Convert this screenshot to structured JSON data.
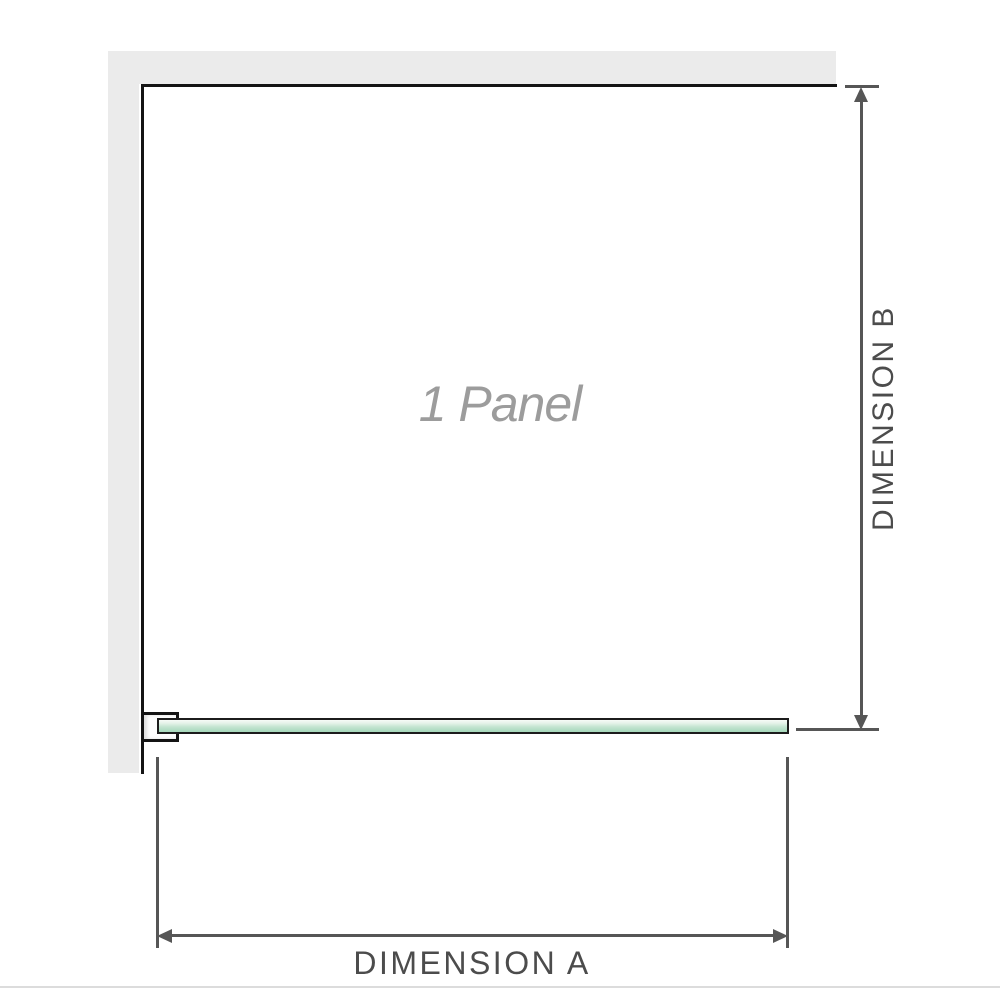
{
  "diagram": {
    "panel_label": "1 Panel",
    "dimension_a": {
      "label": "DIMENSION A",
      "orientation": "horizontal",
      "start_arrow_icon": "arrow-left-icon",
      "end_arrow_icon": "arrow-right-icon"
    },
    "dimension_b": {
      "label": "DIMENSION B",
      "orientation": "vertical",
      "start_arrow_icon": "arrow-up-icon",
      "end_arrow_icon": "arrow-down-icon"
    },
    "colors": {
      "wall_gray": "#ebebeb",
      "outline_black": "#141414",
      "dimension_line": "#565656",
      "dimension_text": "#4c4c4c",
      "panel_label_text": "#9c9c9c",
      "glass_green": "#a6d8bb",
      "glass_highlight": "#f7fbf7"
    }
  }
}
